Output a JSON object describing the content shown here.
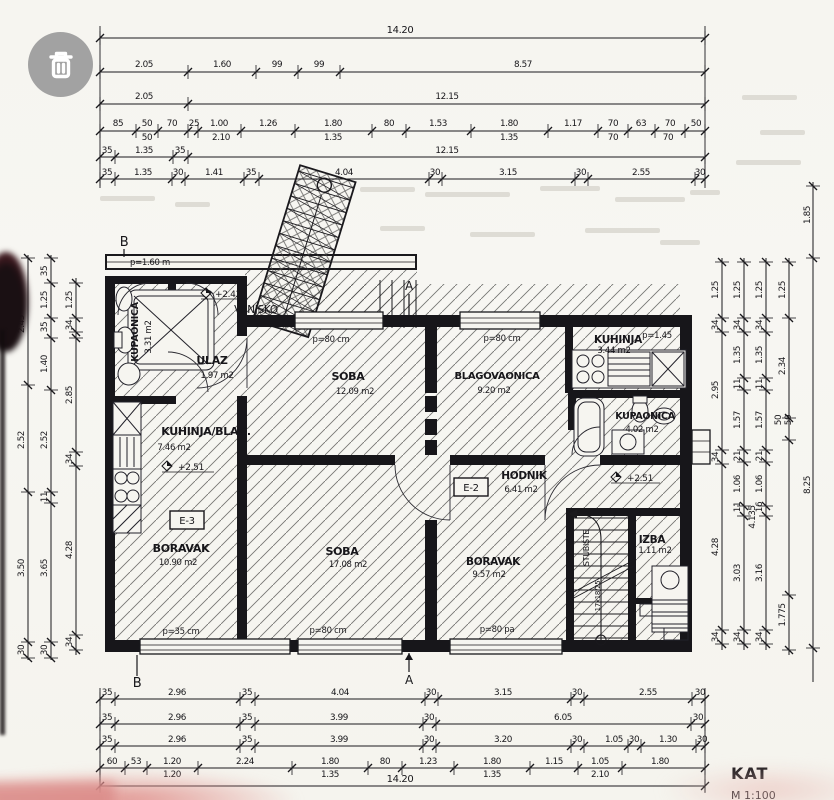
{
  "photo_viewer": {
    "trash_button_icon": "trash-can"
  },
  "floor_plan": {
    "title": "KAT",
    "scale_note": "M 1:100",
    "rooms": [
      {
        "name": "KUPAONICA",
        "area": "3.31 m2"
      },
      {
        "name": "ULAZ",
        "area": "1.97 m2"
      },
      {
        "name": "KUHINJA/BLAG.",
        "area": "7.46 m2"
      },
      {
        "name": "BORAVAK",
        "area": "10.90 m2"
      },
      {
        "name": "SOBA",
        "area": "12.09 m2"
      },
      {
        "name": "BLAGOVAONICA",
        "area": "9.20 m2"
      },
      {
        "name": "KUHINJA",
        "area": "3.44 m2"
      },
      {
        "name": "KUPAONICA",
        "area": "4.02 m2"
      },
      {
        "name": "HODNIK",
        "area": "6.41 m2"
      },
      {
        "name": "SOBA",
        "area": "17.08 m2"
      },
      {
        "name": "BORAVAK",
        "area": "9.57 m2"
      },
      {
        "name": "IZBA",
        "area": "1.11 m2"
      }
    ],
    "annotations": [
      {
        "n": "section-marker-b-top",
        "t": "B",
        "x": 124,
        "y": 246,
        "f": 13
      },
      {
        "n": "section-marker-b-bottom",
        "t": "B",
        "x": 137,
        "y": 687,
        "f": 13
      },
      {
        "n": "section-marker-a-top",
        "t": "A",
        "x": 409,
        "y": 290,
        "f": 12
      },
      {
        "n": "section-marker-a-bottom",
        "t": "A",
        "x": 409,
        "y": 684,
        "f": 12
      },
      {
        "n": "parapet-label",
        "t": "p=1.60 m",
        "x": 150,
        "y": 265,
        "f": 8.5
      },
      {
        "n": "level-mark",
        "t": "+2.42",
        "x": 228,
        "y": 297,
        "f": 9
      },
      {
        "n": "outdoor-label",
        "t": "VANJSKO",
        "x": 256,
        "y": 313,
        "f": 10.5
      },
      {
        "n": "level-mark",
        "t": "+2.51",
        "x": 191,
        "y": 470,
        "f": 9
      },
      {
        "n": "level-mark",
        "t": "+2.51",
        "x": 640,
        "y": 481,
        "f": 9
      },
      {
        "n": "window-label",
        "t": "p=80 cm",
        "x": 331,
        "y": 342,
        "f": 8.5
      },
      {
        "n": "window-label",
        "t": "p=80 cm",
        "x": 502,
        "y": 341,
        "f": 8.5
      },
      {
        "n": "window-label",
        "t": "p=1.45",
        "x": 657,
        "y": 338,
        "f": 8.5
      },
      {
        "n": "window-label",
        "t": "p=35 cm",
        "x": 181,
        "y": 634,
        "f": 8.5
      },
      {
        "n": "window-label",
        "t": "p=80 cm",
        "x": 328,
        "y": 633,
        "f": 8.5
      },
      {
        "n": "window-label",
        "t": "p=80 pa",
        "x": 497,
        "y": 632,
        "f": 8.5
      },
      {
        "n": "electrical-tag",
        "t": "E-3",
        "x": 187,
        "y": 524,
        "f": 10
      },
      {
        "n": "electrical-tag",
        "t": "E-2",
        "x": 471,
        "y": 491,
        "f": 10
      },
      {
        "n": "stair-label",
        "t": "STUBIŠTE",
        "x": 589,
        "y": 548,
        "f": 8,
        "r": 1
      },
      {
        "n": "stair-step-label",
        "t": "17x18/25",
        "x": 600,
        "y": 596,
        "f": 7,
        "r": 1
      }
    ]
  },
  "dimensions": {
    "labels": [
      [
        "14.20",
        400,
        33,
        0,
        10
      ],
      [
        "2.05",
        144,
        67,
        0
      ],
      [
        "1.60",
        222,
        67,
        0
      ],
      [
        "99",
        277,
        67,
        0
      ],
      [
        "99",
        319,
        67,
        0
      ],
      [
        "8.57",
        523,
        67,
        0
      ],
      [
        "2.05",
        144,
        99,
        0
      ],
      [
        "12.15",
        447,
        99,
        0
      ],
      [
        "85",
        118,
        126,
        0
      ],
      [
        "50",
        147,
        126,
        0
      ],
      [
        "70",
        172,
        126,
        0
      ],
      [
        "25",
        194,
        126,
        0
      ],
      [
        "1.00",
        219,
        126,
        0
      ],
      [
        "1.26",
        268,
        126,
        0
      ],
      [
        "1.80",
        333,
        126,
        0
      ],
      [
        "80",
        389,
        126,
        0
      ],
      [
        "1.53",
        438,
        126,
        0
      ],
      [
        "1.80",
        509,
        126,
        0
      ],
      [
        "1.17",
        573,
        126,
        0
      ],
      [
        "70",
        613,
        126,
        0
      ],
      [
        "63",
        641,
        126,
        0
      ],
      [
        "70",
        670,
        126,
        0
      ],
      [
        "50",
        696,
        126,
        0
      ],
      [
        "50",
        147,
        140,
        0
      ],
      [
        "2.10",
        221,
        140,
        0
      ],
      [
        "1.35",
        333,
        140,
        0
      ],
      [
        "1.35",
        509,
        140,
        0
      ],
      [
        "70",
        613,
        140,
        0
      ],
      [
        "70",
        668,
        140,
        0
      ],
      [
        "35",
        107,
        153,
        0
      ],
      [
        "1.35",
        144,
        153,
        0
      ],
      [
        "35",
        180,
        153,
        0
      ],
      [
        "12.15",
        447,
        153,
        0
      ],
      [
        "35",
        107,
        175,
        0
      ],
      [
        "1.35",
        143,
        175,
        0
      ],
      [
        "30",
        178,
        175,
        0
      ],
      [
        "1.41",
        214,
        175,
        0
      ],
      [
        "35",
        251,
        175,
        0
      ],
      [
        "4.04",
        344,
        175,
        0
      ],
      [
        "30",
        435,
        175,
        0
      ],
      [
        "3.15",
        508,
        175,
        0
      ],
      [
        "30",
        581,
        175,
        0
      ],
      [
        "2.55",
        641,
        175,
        0
      ],
      [
        "30",
        700,
        175,
        0
      ],
      [
        "35",
        107,
        695,
        0
      ],
      [
        "2.96",
        177,
        695,
        0
      ],
      [
        "35",
        247,
        695,
        0
      ],
      [
        "4.04",
        340,
        695,
        0
      ],
      [
        "30",
        431,
        695,
        0
      ],
      [
        "3.15",
        503,
        695,
        0
      ],
      [
        "30",
        577,
        695,
        0
      ],
      [
        "2.55",
        648,
        695,
        0
      ],
      [
        "30",
        700,
        695,
        0
      ],
      [
        "35",
        107,
        720,
        0
      ],
      [
        "2.96",
        177,
        720,
        0
      ],
      [
        "35",
        247,
        720,
        0
      ],
      [
        "3.99",
        339,
        720,
        0
      ],
      [
        "30",
        429,
        720,
        0
      ],
      [
        "6.05",
        563,
        720,
        0
      ],
      [
        "30",
        698,
        720,
        0
      ],
      [
        "35",
        107,
        742,
        0
      ],
      [
        "2.96",
        177,
        742,
        0
      ],
      [
        "35",
        247,
        742,
        0
      ],
      [
        "3.99",
        339,
        742,
        0
      ],
      [
        "30",
        429,
        742,
        0
      ],
      [
        "3.20",
        503,
        742,
        0
      ],
      [
        "30",
        577,
        742,
        0
      ],
      [
        "1.05",
        614,
        742,
        0
      ],
      [
        "30",
        634,
        742,
        0
      ],
      [
        "1.30",
        668,
        742,
        0
      ],
      [
        "30",
        702,
        742,
        0
      ],
      [
        "60",
        112,
        764,
        0
      ],
      [
        "53",
        136,
        764,
        0
      ],
      [
        "1.20",
        172,
        764,
        0
      ],
      [
        "2.24",
        245,
        764,
        0
      ],
      [
        "1.80",
        330,
        764,
        0
      ],
      [
        "80",
        385,
        764,
        0
      ],
      [
        "1.23",
        428,
        764,
        0
      ],
      [
        "1.80",
        492,
        764,
        0
      ],
      [
        "1.15",
        554,
        764,
        0
      ],
      [
        "1.05",
        600,
        764,
        0
      ],
      [
        "1.80",
        660,
        764,
        0
      ],
      [
        "1.20",
        172,
        777,
        0
      ],
      [
        "1.35",
        330,
        777,
        0
      ],
      [
        "1.35",
        492,
        777,
        0
      ],
      [
        "2.10",
        600,
        777,
        0
      ],
      [
        "14.20",
        400,
        782,
        0,
        10
      ],
      [
        "2.45",
        24,
        324,
        1
      ],
      [
        "2.52",
        24,
        440,
        1
      ],
      [
        "3.50",
        24,
        568,
        1
      ],
      [
        "30",
        24,
        650,
        1
      ],
      [
        "35",
        47,
        271,
        1
      ],
      [
        "1.25",
        47,
        300,
        1
      ],
      [
        "35",
        47,
        327,
        1
      ],
      [
        "1.40",
        47,
        364,
        1
      ],
      [
        "2.52",
        47,
        440,
        1
      ],
      [
        "11",
        47,
        497,
        1
      ],
      [
        "3.65",
        47,
        568,
        1
      ],
      [
        "30",
        47,
        650,
        1
      ],
      [
        "1.25",
        72,
        300,
        1
      ],
      [
        "34",
        72,
        325,
        1
      ],
      [
        "2.85",
        72,
        395,
        1
      ],
      [
        "34",
        72,
        459,
        1
      ],
      [
        "4.28",
        72,
        550,
        1
      ],
      [
        "34",
        72,
        642,
        1
      ],
      [
        "1.25",
        718,
        290,
        1
      ],
      [
        "34",
        718,
        325,
        1
      ],
      [
        "2.95",
        718,
        390,
        1
      ],
      [
        "34",
        718,
        457,
        1
      ],
      [
        "4.28",
        718,
        547,
        1
      ],
      [
        "34",
        718,
        637,
        1
      ],
      [
        "1.25",
        740,
        290,
        1
      ],
      [
        "34",
        740,
        325,
        1
      ],
      [
        "1.35",
        740,
        355,
        1
      ],
      [
        "11",
        740,
        384,
        1
      ],
      [
        "1.57",
        740,
        420,
        1
      ],
      [
        "21",
        740,
        456,
        1
      ],
      [
        "1.06",
        740,
        484,
        1
      ],
      [
        "11",
        740,
        507,
        1
      ],
      [
        "3.03",
        740,
        573,
        1
      ],
      [
        "34",
        740,
        637,
        1
      ],
      [
        "1.25",
        762,
        290,
        1
      ],
      [
        "34",
        762,
        325,
        1
      ],
      [
        "1.35",
        762,
        355,
        1
      ],
      [
        "11",
        762,
        384,
        1
      ],
      [
        "1.57",
        762,
        420,
        1
      ],
      [
        "21",
        762,
        456,
        1
      ],
      [
        "1.06",
        762,
        484,
        1
      ],
      [
        "16",
        762,
        507,
        1
      ],
      [
        "3.16",
        762,
        573,
        1
      ],
      [
        "34",
        762,
        637,
        1
      ],
      [
        "1.25",
        785,
        290,
        1
      ],
      [
        "2.34",
        785,
        366,
        1
      ],
      [
        "50",
        781,
        420,
        1
      ],
      [
        "50",
        791,
        420,
        1
      ],
      [
        "4.135",
        755,
        517,
        1
      ],
      [
        "1.775",
        785,
        615,
        1
      ],
      [
        "1.85",
        810,
        215,
        1
      ],
      [
        "8.25",
        810,
        485,
        1
      ]
    ]
  }
}
